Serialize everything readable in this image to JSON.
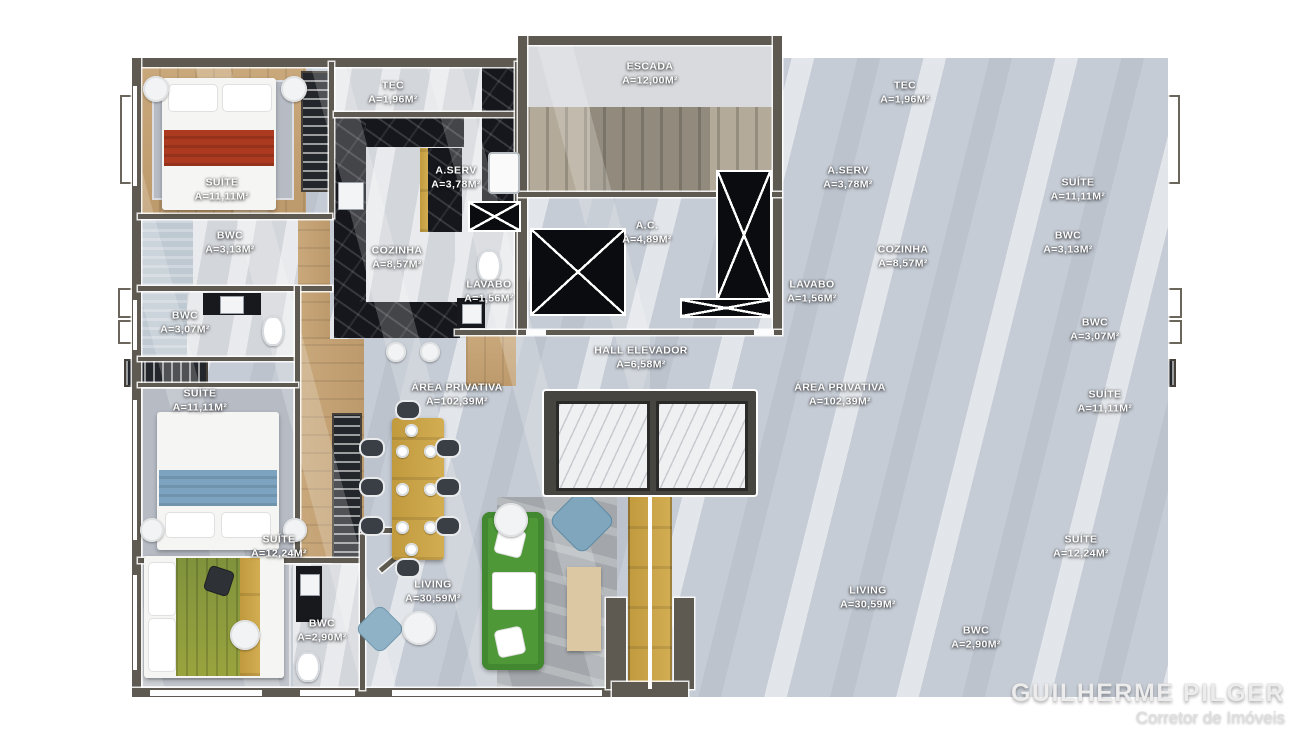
{
  "palette": {
    "wall": "#5e5a51",
    "floor_tile": "#c6ccd5",
    "wood": "#c4a173",
    "marble_black": "#15171c",
    "bed_red": "#ac3a20",
    "bed_blue": "#7ca4c0",
    "bed_green": "#8a9a3d",
    "sofa_green": "#4e9838",
    "divider_gold": "#c7a143"
  },
  "core": {
    "escada": {
      "name": "ESCADA",
      "area": "A=12,00M²"
    },
    "ac": {
      "name": "A.C.",
      "area": "A=4,89M²"
    },
    "hall": {
      "name": "HALL ELEVADOR",
      "area": "A=6,58M²"
    }
  },
  "unit": {
    "suite_top": {
      "name": "SUÍTE",
      "area": "A=11,11M²"
    },
    "tec": {
      "name": "TEC",
      "area": "A=1,96M²"
    },
    "aserv": {
      "name": "A.SERV",
      "area": "A=3,78M²"
    },
    "bwc_suite": {
      "name": "BWC",
      "area": "A=3,13M²"
    },
    "cozinha": {
      "name": "COZINHA",
      "area": "A=8,57M²"
    },
    "lavabo": {
      "name": "LAVABO",
      "area": "A=1,56M²"
    },
    "bwc_mid": {
      "name": "BWC",
      "area": "A=3,07M²"
    },
    "suite_mid": {
      "name": "SUÍTE",
      "area": "A=11,11M²"
    },
    "area_privativa": {
      "name": "ÁREA PRIVATIVA",
      "area": "A=102,39M²"
    },
    "suite_bottom": {
      "name": "SUÍTE",
      "area": "A=12,24M²"
    },
    "living": {
      "name": "LIVING",
      "area": "A=30,59M²"
    },
    "bwc_bottom": {
      "name": "BWC",
      "area": "A=2,90M²"
    }
  },
  "watermark": {
    "name": "GUILHERME PILGER",
    "role": "Corretor de Imóveis"
  }
}
